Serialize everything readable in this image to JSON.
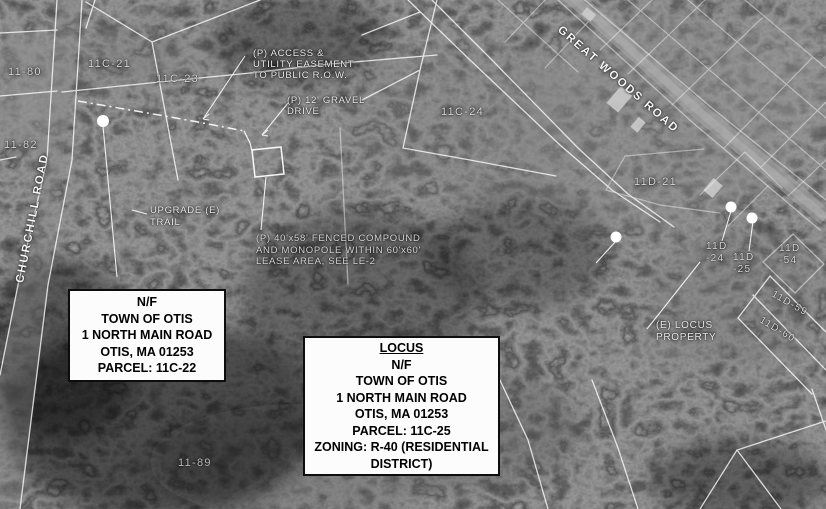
{
  "roads": {
    "churchill_road": "CHURCHILL ROAD",
    "great_woods_road": "GREAT WOODS ROAD"
  },
  "parcels": {
    "p11_80": "11-80",
    "p11_82": "11-82",
    "p11_89": "11-89",
    "p11c_21": "11C-21",
    "p11c_23": "11C-23",
    "p11c_24": "11C-24",
    "p11d_21": "11D-21",
    "p11d_24": "11D\n-24",
    "p11d_25": "11D\n-25",
    "p11d_54": "11D\n-54",
    "p11d_59": "11D-59",
    "p11d_60": "11D-60"
  },
  "annotations": {
    "access_easement": "(P) ACCESS &\nUTILITY EASEMENT\nTO PUBLIC R.O.W.",
    "gravel_drive": "(P) 12' GRAVEL\nDRIVE",
    "upgrade_trail": "UPGRADE (E)\nTRAIL",
    "fenced_compound": "(P) 40'x58' FENCED COMPOUND\nAND MONOPOLE WITHIN 60'x60'\nLEASE AREA, SEE LE-2",
    "locus_property": "(E) LOCUS\nPROPERTY"
  },
  "info_boxes": {
    "parcel_box": {
      "lines": [
        "N/F",
        "TOWN OF OTIS",
        "1 NORTH MAIN ROAD",
        "OTIS, MA 01253",
        "PARCEL: 11C-22"
      ]
    },
    "locus_box": {
      "title": "LOCUS",
      "lines": [
        "N/F",
        "TOWN OF OTIS",
        "1 NORTH MAIN ROAD",
        "OTIS, MA 01253",
        "PARCEL: 11C-25",
        "ZONING: R-40 (RESIDENTIAL",
        "DISTRICT)"
      ]
    }
  },
  "map_features": {
    "survey_marker_count": 4,
    "colors": {
      "photo_dark": "#1a1a1a",
      "linework": "#ffffff",
      "label_text": "#ececec",
      "box_background": "#fcfcfc",
      "box_text": "#000000"
    }
  }
}
